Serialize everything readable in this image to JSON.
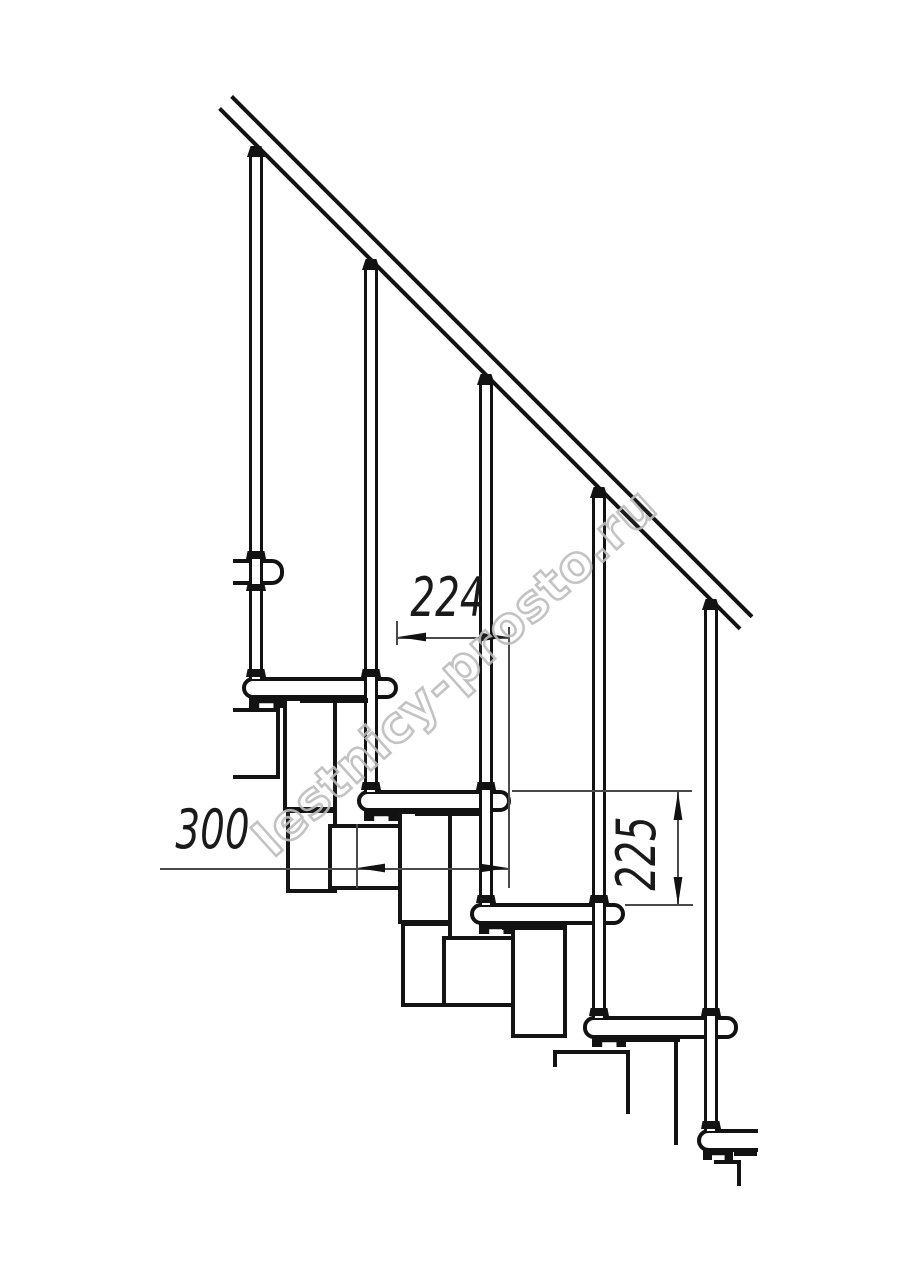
{
  "drawing": {
    "type": "staircase-side-elevation-drawing",
    "dimensions": {
      "going": "224",
      "tread": "300",
      "rise": "225"
    },
    "watermark": "lestnicy-prosto.ru",
    "colors": {
      "line": "#121212",
      "dim_line": "#4a4a4a",
      "watermark_outline": "#bdbdbd",
      "background": "#ffffff"
    }
  }
}
